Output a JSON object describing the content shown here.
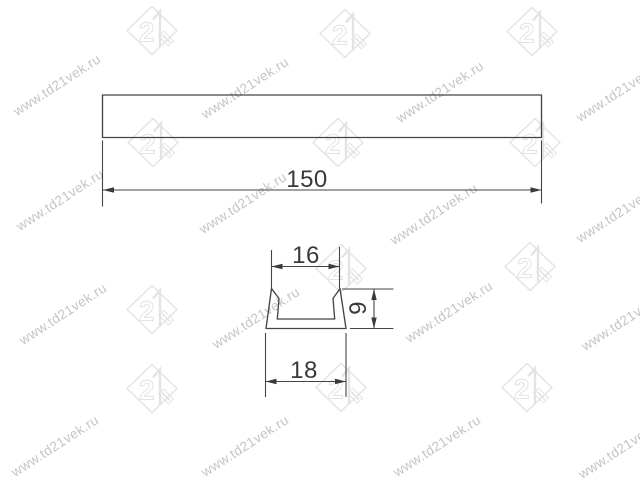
{
  "page": {
    "background_color": "#ffffff"
  },
  "watermark": {
    "text": "www.td21vek.ru",
    "logo_number": "21",
    "text_color": "#c3c4c6",
    "logo_color": "#e3e3e4"
  },
  "drawing": {
    "type": "technical-dimension-drawing",
    "line_color": "#454545",
    "text_color": "#3a3a3a",
    "views": {
      "front": {
        "description": "long profile bar, top view",
        "length": {
          "label": "150",
          "value": 150
        }
      },
      "section": {
        "description": "U-channel profile cross-section",
        "top_width": {
          "label": "16",
          "value": 16
        },
        "bottom_width": {
          "label": "18",
          "value": 18
        },
        "height": {
          "label": "9",
          "value": 9
        }
      }
    }
  }
}
